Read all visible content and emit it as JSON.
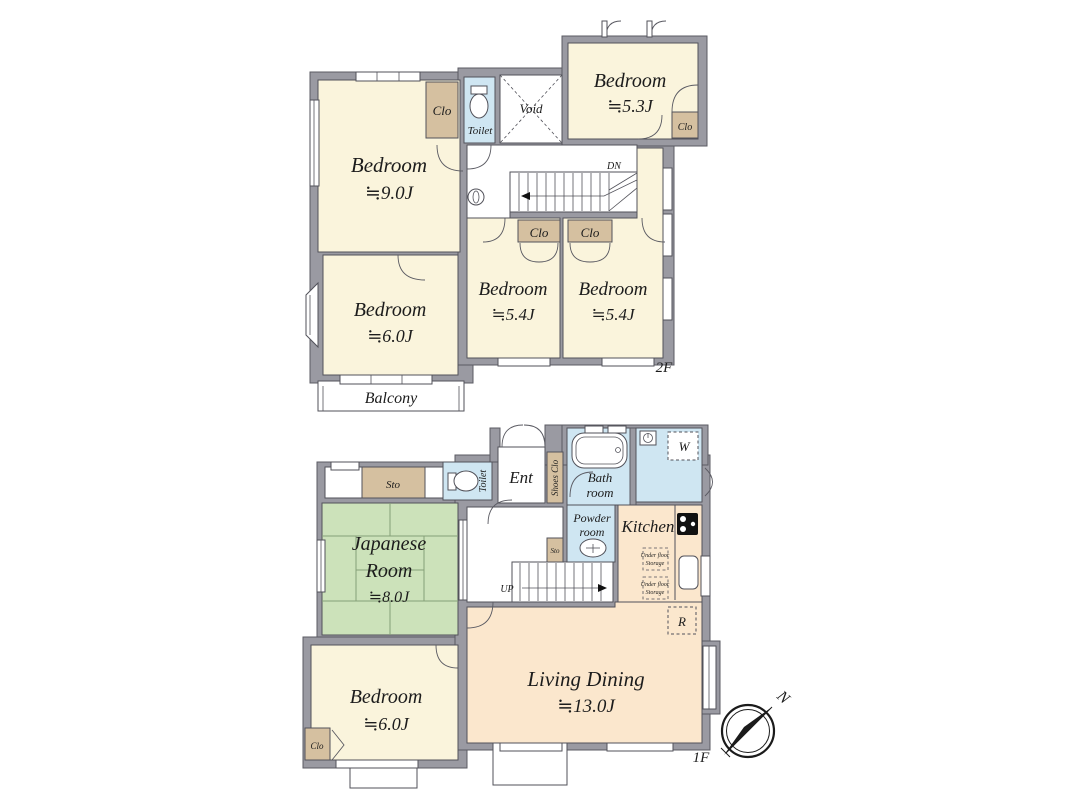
{
  "f2": {
    "floor_label": "2F",
    "bedroom9": {
      "name": "Bedroom",
      "size": "≒9.0J"
    },
    "bedroom53": {
      "name": "Bedroom",
      "size": "≒5.3J"
    },
    "bedroom54a": {
      "name": "Bedroom",
      "size": "≒5.4J"
    },
    "bedroom54b": {
      "name": "Bedroom",
      "size": "≒5.4J"
    },
    "bedroom6": {
      "name": "Bedroom",
      "size": "≒6.0J"
    },
    "clo_bed9": "Clo",
    "clo_bed53": "Clo",
    "clo_hall_left": "Clo",
    "clo_hall_right": "Clo",
    "toilet": "Toilet",
    "void": "Void",
    "down": "DN",
    "balcony": "Balcony"
  },
  "f1": {
    "floor_label": "1F",
    "sto": "Sto",
    "toilet": "Toilet",
    "entrance": "Ent",
    "shoes_clo": "Shoes Clo",
    "bath": {
      "line1": "Bath",
      "line2": "room"
    },
    "washer": "W",
    "powder": {
      "line1": "Powder",
      "line2": "room"
    },
    "kitchen": "Kitchen",
    "sto_small": "Sto",
    "up": "UP",
    "under_floor_storage": {
      "line1": "Under floor",
      "line2": "Storage"
    },
    "fridge": "R",
    "japanese": {
      "line1": "Japanese",
      "line2": "Room",
      "size": "≒8.0J"
    },
    "bedroom6": {
      "name": "Bedroom",
      "size": "≒6.0J"
    },
    "clo": "Clo",
    "living": {
      "name": "Living Dining",
      "size": "≒13.0J"
    }
  },
  "compass": {
    "north": "N"
  },
  "colors": {
    "wall": "#9a9aa2",
    "room_cream": "#faf4dc",
    "closet_tan": "#d5c0a0",
    "water_blue": "#cfe6f2",
    "tatami_green": "#cce2ba",
    "ld_peach": "#fbe7cd"
  }
}
